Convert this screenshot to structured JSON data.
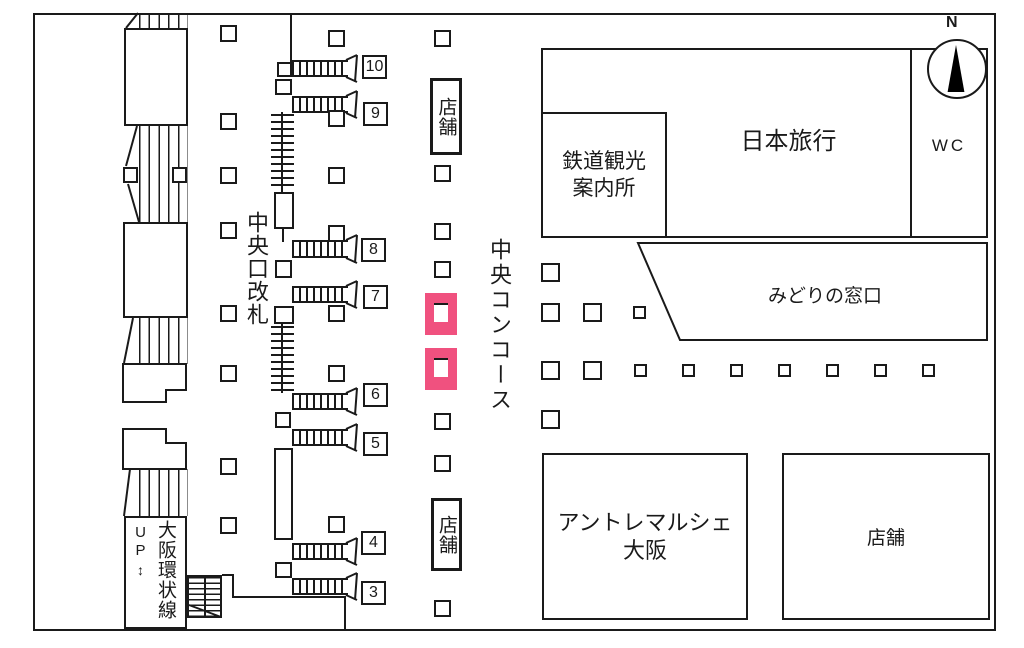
{
  "map": {
    "labels": {
      "central_gate": "中央口改札",
      "central_concourse": "中央コンコース",
      "shop_top": "店舗",
      "shop_bottom": "店舗",
      "rail_tourist_info_line1": "鉄道観光",
      "rail_tourist_info_line2": "案内所",
      "nippon_travel": "日本旅行",
      "wc": "WC",
      "north": "N",
      "midori_no_madoguchi": "みどりの窓口",
      "entree_marche_line1": "アントレマルシェ",
      "entree_marche_line2": "大阪",
      "shop_bottom_right": "店舗",
      "up": "UP",
      "up_arrow": "↕",
      "osaka_loop_line": "大阪環状線"
    },
    "platform_numbers": [
      "10",
      "9",
      "8",
      "7",
      "6",
      "5",
      "4",
      "3"
    ],
    "colors": {
      "highlight_pink": "#F0517F",
      "line_black": "#1A1A1A",
      "background": "#FFFFFF"
    }
  }
}
